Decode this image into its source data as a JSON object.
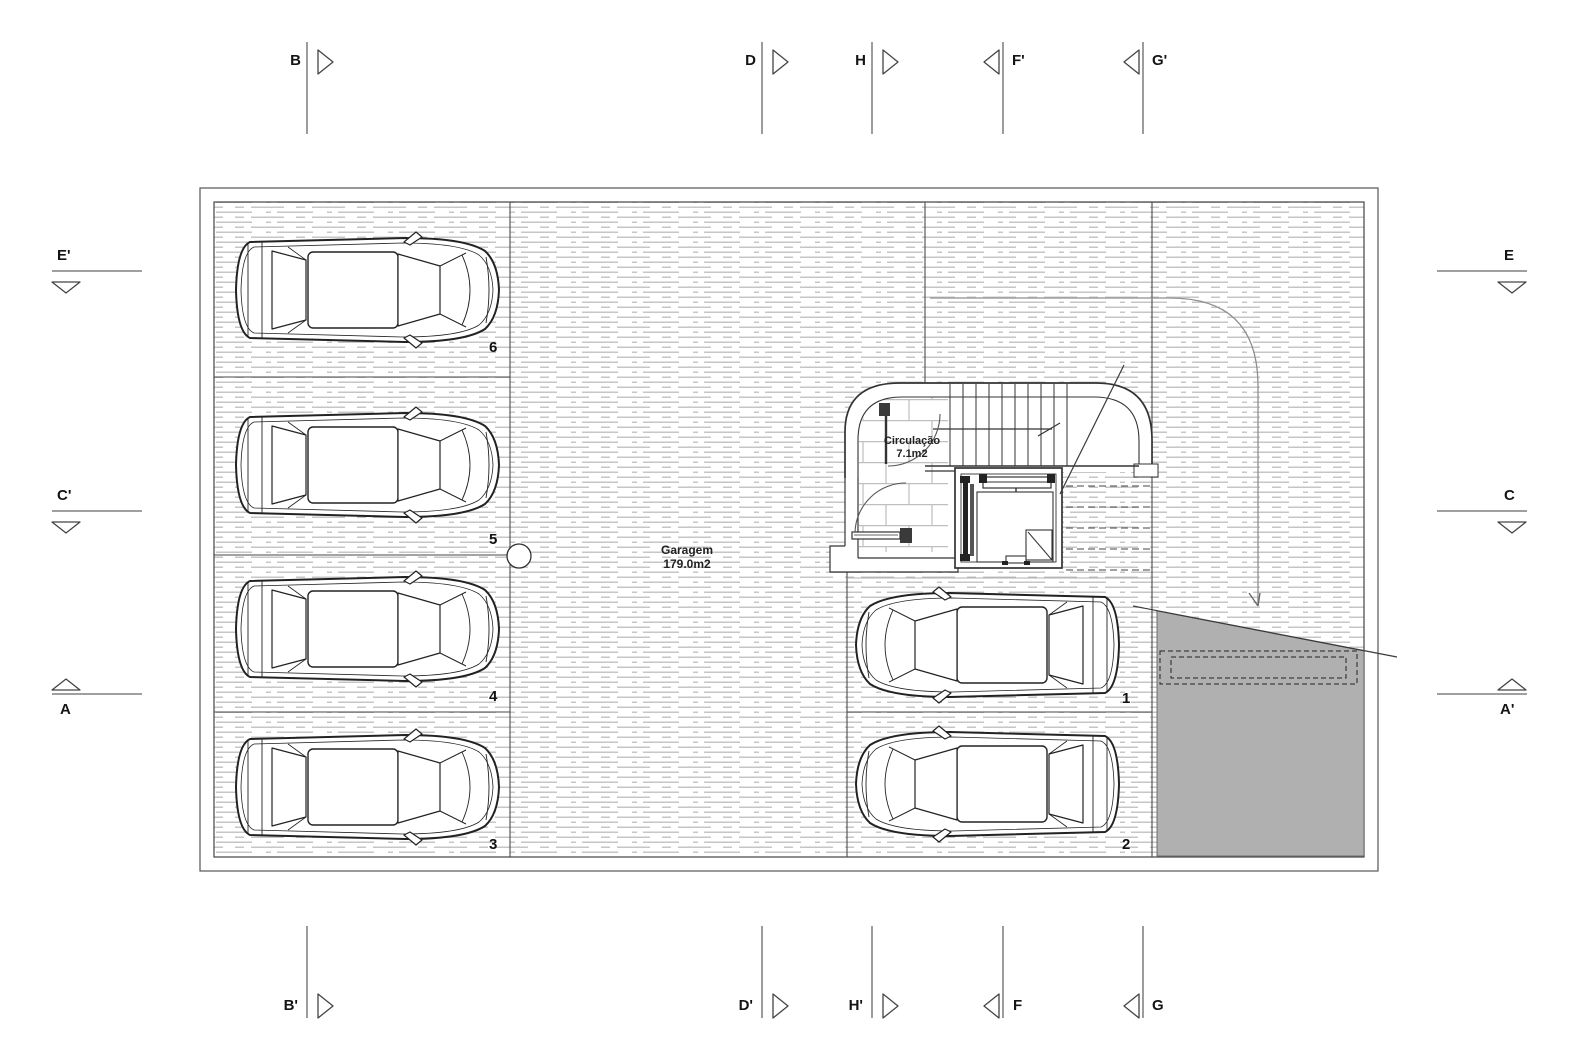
{
  "drawing": {
    "kind": "garage floor plan",
    "rooms": {
      "garagem": {
        "name": "Garagem",
        "area": "179.0m2"
      },
      "circulacao": {
        "name": "Circulação",
        "area": "7.1m2"
      }
    },
    "stalls": [
      {
        "number": "1"
      },
      {
        "number": "2"
      },
      {
        "number": "3"
      },
      {
        "number": "4"
      },
      {
        "number": "5"
      },
      {
        "number": "6"
      }
    ],
    "markers": {
      "top": [
        {
          "label": "B"
        },
        {
          "label": "D"
        },
        {
          "label": "H"
        },
        {
          "label": "F'"
        },
        {
          "label": "G'"
        }
      ],
      "bottom": [
        {
          "label": "B'"
        },
        {
          "label": "D'"
        },
        {
          "label": "H'"
        },
        {
          "label": "F"
        },
        {
          "label": "G"
        }
      ],
      "left": [
        {
          "label": "E'"
        },
        {
          "label": "C'"
        },
        {
          "label": "A"
        }
      ],
      "right": [
        {
          "label": "E"
        },
        {
          "label": "C"
        },
        {
          "label": "A'"
        }
      ]
    },
    "colors": {
      "line": "#3a3a3a",
      "hatch_line": "#c6c6c6",
      "ramp_fill": "#b0b0b0",
      "tile_line": "#bfbfbf",
      "background": "#ffffff"
    }
  }
}
